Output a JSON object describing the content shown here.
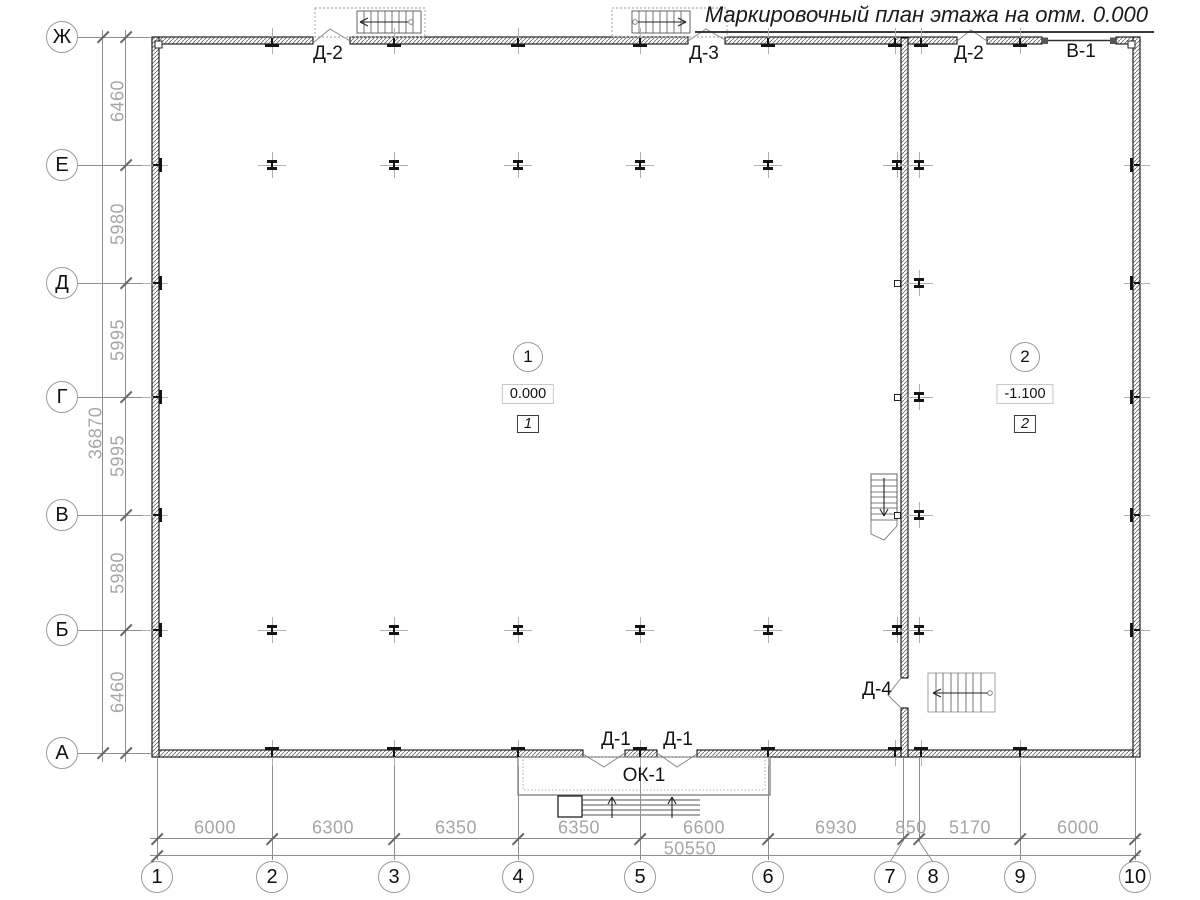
{
  "title": "Маркировочный план этажа на отм. 0.000",
  "colors": {
    "line": "#1a1a1a",
    "thin": "#8f8f8f",
    "dim_text": "#a6a6a6"
  },
  "axes": {
    "rows": [
      {
        "label": "Ж",
        "y": 37
      },
      {
        "label": "Е",
        "y": 165
      },
      {
        "label": "Д",
        "y": 283
      },
      {
        "label": "Г",
        "y": 397
      },
      {
        "label": "В",
        "y": 515
      },
      {
        "label": "Б",
        "y": 630
      },
      {
        "label": "А",
        "y": 753
      }
    ],
    "cols": [
      {
        "label": "1",
        "x": 157,
        "cx": 157
      },
      {
        "label": "2",
        "x": 272,
        "cx": 272
      },
      {
        "label": "3",
        "x": 394,
        "cx": 394
      },
      {
        "label": "4",
        "x": 518,
        "cx": 518
      },
      {
        "label": "5",
        "x": 640,
        "cx": 640
      },
      {
        "label": "6",
        "x": 768,
        "cx": 768
      },
      {
        "label": "7",
        "x": 903,
        "cx": 890
      },
      {
        "label": "8",
        "x": 919,
        "cx": 933
      },
      {
        "label": "9",
        "x": 1020,
        "cx": 1020
      },
      {
        "label": "10",
        "x": 1135,
        "cx": 1135
      }
    ],
    "row_dims": [
      {
        "text": "6460",
        "y": 101
      },
      {
        "text": "5980",
        "y": 224
      },
      {
        "text": "5995",
        "y": 340
      },
      {
        "text": "5995",
        "y": 456
      },
      {
        "text": "5980",
        "y": 573
      },
      {
        "text": "6460",
        "y": 692
      }
    ],
    "row_total": {
      "text": "36870",
      "y": 433
    },
    "col_dims": [
      {
        "text": "6000",
        "x": 215
      },
      {
        "text": "6300",
        "x": 333
      },
      {
        "text": "6350",
        "x": 456
      },
      {
        "text": "6350",
        "x": 579
      },
      {
        "text": "6600",
        "x": 704
      },
      {
        "text": "6930",
        "x": 836
      },
      {
        "text": "850",
        "x": 911
      },
      {
        "text": "5170",
        "x": 970
      },
      {
        "text": "6000",
        "x": 1078
      }
    ],
    "col_total": {
      "text": "50550",
      "x": 690
    }
  },
  "door_labels": [
    {
      "text": "Д-2",
      "x": 328,
      "y": 54
    },
    {
      "text": "Д-3",
      "x": 704,
      "y": 54
    },
    {
      "text": "Д-2",
      "x": 969,
      "y": 54
    },
    {
      "text": "В-1",
      "x": 1081,
      "y": 52
    },
    {
      "text": "Д-1",
      "x": 616,
      "y": 740
    },
    {
      "text": "Д-1",
      "x": 678,
      "y": 740
    },
    {
      "text": "ОК-1",
      "x": 644,
      "y": 776
    },
    {
      "text": "Д-4",
      "x": 877,
      "y": 690
    }
  ],
  "rooms": [
    {
      "number": "1",
      "elevation": "0.000",
      "zone": "1",
      "x": 528,
      "y": 357
    },
    {
      "number": "2",
      "elevation": "-1.100",
      "zone": "2",
      "x": 1025,
      "y": 357
    }
  ],
  "columns": [
    {
      "x": 272,
      "y": 165
    },
    {
      "x": 394,
      "y": 165
    },
    {
      "x": 518,
      "y": 165
    },
    {
      "x": 640,
      "y": 165
    },
    {
      "x": 768,
      "y": 165
    },
    {
      "x": 897,
      "y": 165
    },
    {
      "x": 919,
      "y": 165
    },
    {
      "x": 919,
      "y": 283
    },
    {
      "x": 919,
      "y": 397
    },
    {
      "x": 919,
      "y": 515
    },
    {
      "x": 272,
      "y": 630
    },
    {
      "x": 394,
      "y": 630
    },
    {
      "x": 518,
      "y": 630
    },
    {
      "x": 640,
      "y": 630
    },
    {
      "x": 768,
      "y": 630
    },
    {
      "x": 897,
      "y": 630
    },
    {
      "x": 919,
      "y": 630
    }
  ],
  "wall_squares": [
    {
      "x": 897,
      "y": 283
    },
    {
      "x": 897,
      "y": 397
    },
    {
      "x": 897,
      "y": 515
    }
  ],
  "ticks": {
    "top": [
      272,
      394,
      518,
      640,
      768,
      895,
      921,
      1020
    ],
    "bottom": [
      272,
      394,
      518,
      640,
      768,
      895,
      921,
      1020
    ],
    "left": [
      165,
      283,
      397,
      515,
      630
    ],
    "right": [
      165,
      283,
      397,
      515,
      630
    ]
  }
}
